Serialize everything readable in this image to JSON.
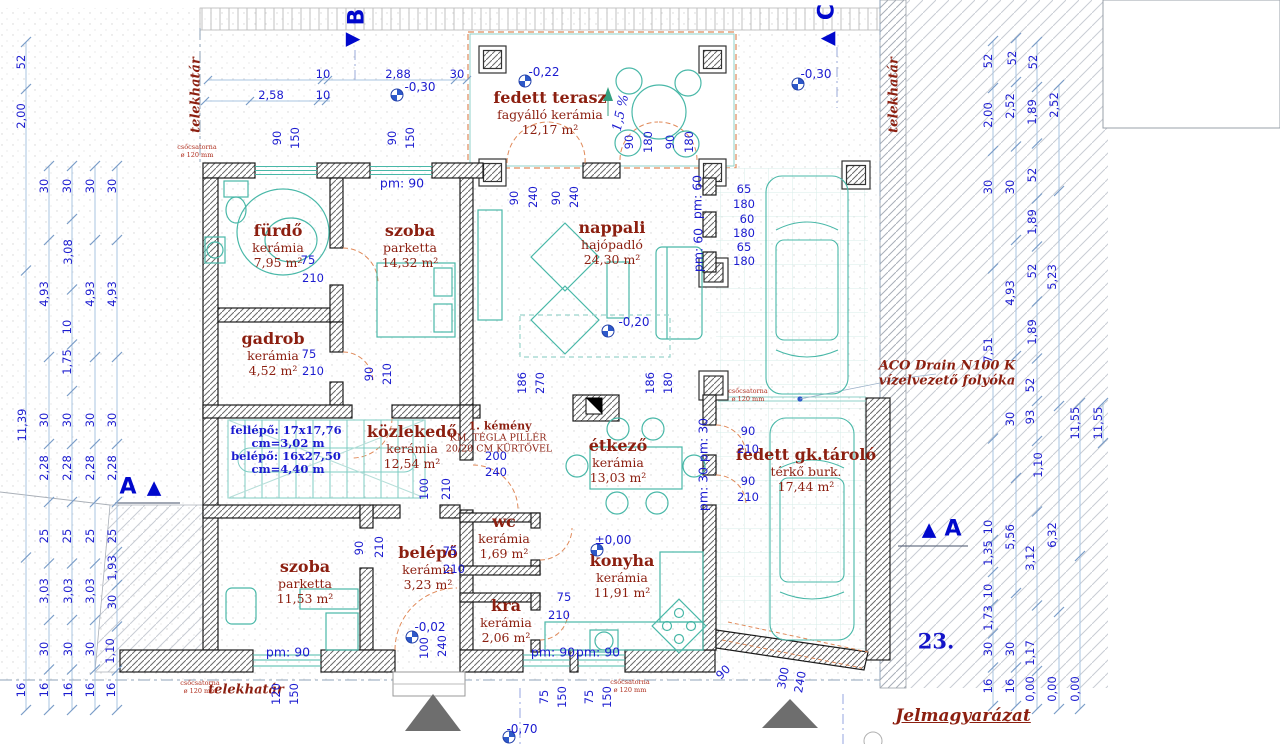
{
  "sheet": {
    "number": "23.",
    "legend_title": "Jelmagyarázat"
  },
  "colors": {
    "dim_blue": "#1b1bd0",
    "room_red": "#8c1f10",
    "teal": "#49b8a8",
    "orange": "#e08a5a",
    "section_blue": "#0008cc"
  },
  "rooms": [
    {
      "id": "furdo",
      "name": "fürdő",
      "finish": "kerámia",
      "area": "7,95 m²",
      "x": 278,
      "y": 243
    },
    {
      "id": "szoba-top",
      "name": "szoba",
      "finish": "parketta",
      "area": "14,32 m²",
      "x": 410,
      "y": 243
    },
    {
      "id": "gadrob",
      "name": "gadrob",
      "finish": "kerámia",
      "area": "4,52 m²",
      "x": 273,
      "y": 351
    },
    {
      "id": "fedett-terasz",
      "name": "fedett terasz",
      "finish": "fagyálló kerámia",
      "area": "12,17 m²",
      "x": 550,
      "y": 110
    },
    {
      "id": "nappali",
      "name": "nappali",
      "finish": "hajópadló",
      "area": "24,30 m²",
      "x": 612,
      "y": 240
    },
    {
      "id": "etkezo",
      "name": "étkező",
      "finish": "kerámia",
      "area": "13,03 m²",
      "x": 618,
      "y": 458
    },
    {
      "id": "kozlekedo",
      "name": "közlekedő",
      "finish": "kerámia",
      "area": "12,54 m²",
      "x": 412,
      "y": 444
    },
    {
      "id": "wc",
      "name": "wc",
      "finish": "kerámia",
      "area": "1,69 m²",
      "x": 504,
      "y": 534
    },
    {
      "id": "konyha",
      "name": "konyha",
      "finish": "kerámia",
      "area": "11,91 m²",
      "x": 622,
      "y": 573
    },
    {
      "id": "belepo",
      "name": "belépő",
      "finish": "kerámia",
      "area": "3,23 m²",
      "x": 428,
      "y": 565
    },
    {
      "id": "kra",
      "name": "kra",
      "finish": "kerámia",
      "area": "2,06 m²",
      "x": 506,
      "y": 618
    },
    {
      "id": "szoba-bottom",
      "name": "szoba",
      "finish": "parketta",
      "area": "11,53 m²",
      "x": 305,
      "y": 579
    },
    {
      "id": "fedett-gk-tarolo",
      "name": "fedett gk.tároló",
      "finish": "térkő burk.",
      "area": "17,44 m²",
      "x": 806,
      "y": 467
    }
  ],
  "texts": [
    {
      "n": "telekhatar-left",
      "t": "telekhatár",
      "x": 196,
      "y": 95,
      "r": -90,
      "c": "redital"
    },
    {
      "n": "telekhatar-right",
      "t": "telekhatár",
      "x": 894,
      "y": 95,
      "r": -90,
      "c": "redital"
    },
    {
      "n": "telekhatar-bottom",
      "t": "telekhatár",
      "x": 246,
      "y": 690,
      "c": "redital"
    },
    {
      "n": "aco-drain-line1",
      "t": "ACO Drain N100 K",
      "x": 947,
      "y": 366,
      "c": "redital"
    },
    {
      "n": "aco-drain-line2",
      "t": "vízelvezető folyóka",
      "x": 947,
      "y": 381,
      "c": "redital"
    },
    {
      "n": "kemeny-note-1",
      "t": "1. kémény",
      "x": 500,
      "y": 426,
      "c": "kem1"
    },
    {
      "n": "kemeny-note-2",
      "t": "KM. TÉGLA PILLÉR",
      "x": 498,
      "y": 438,
      "c": "kem2"
    },
    {
      "n": "kemeny-note-3",
      "t": "20/20 CM KÜRTŐVEL",
      "x": 499,
      "y": 449,
      "c": "kem2"
    },
    {
      "n": "stair-note-1",
      "t": "fellépő: 17x17,76",
      "x": 286,
      "y": 430,
      "c": "bluebold"
    },
    {
      "n": "stair-note-2",
      "t": "cm=3,02 m",
      "x": 288,
      "y": 443,
      "c": "bluebold"
    },
    {
      "n": "stair-note-3",
      "t": "belépő: 16x27,50",
      "x": 286,
      "y": 456,
      "c": "bluebold"
    },
    {
      "n": "stair-note-4",
      "t": "cm=4,40 m",
      "x": 288,
      "y": 469,
      "c": "bluebold"
    },
    {
      "n": "downpipe-note-1",
      "t": "csőcsatorna\nø 120 mm",
      "x": 197,
      "y": 151,
      "c": "tiny"
    },
    {
      "n": "downpipe-note-2",
      "t": "csőcsatorna\nø 120 mm",
      "x": 748,
      "y": 395,
      "c": "tiny"
    },
    {
      "n": "downpipe-note-3",
      "t": "csőcsatorna\nø 120 mm",
      "x": 200,
      "y": 687,
      "c": "tiny"
    },
    {
      "n": "downpipe-note-4",
      "t": "csőcsatorna\nø 120 mm",
      "x": 630,
      "y": 686,
      "c": "tiny"
    },
    {
      "n": "slope-label",
      "t": "1,5 %",
      "x": 621,
      "y": 113,
      "r": -78,
      "c": "pct"
    }
  ],
  "levels": [
    {
      "t": "-0,22",
      "sx": 525,
      "sy": 81,
      "tx": 544,
      "ty": 72
    },
    {
      "t": "-0,30",
      "sx": 397,
      "sy": 95,
      "tx": 420,
      "ty": 87
    },
    {
      "t": "-0,30",
      "sx": 798,
      "sy": 84,
      "tx": 816,
      "ty": 74
    },
    {
      "t": "-0,20",
      "sx": 608,
      "sy": 331,
      "tx": 634,
      "ty": 322
    },
    {
      "t": "±0,00",
      "sx": 597,
      "sy": 550,
      "tx": 613,
      "ty": 540
    },
    {
      "t": "-0,02",
      "sx": 412,
      "sy": 637,
      "tx": 430,
      "ty": 627
    },
    {
      "t": "-0,70",
      "sx": 509,
      "sy": 737,
      "tx": 522,
      "ty": 729
    }
  ],
  "sections": [
    {
      "letter": "B",
      "lx": 357,
      "ly": 17,
      "lr": -90,
      "tri": "▶",
      "tx": 353,
      "ty": 39
    },
    {
      "letter": "C",
      "lx": 827,
      "ly": 12,
      "lr": -90,
      "tri": "◀",
      "tx": 828,
      "ty": 38
    },
    {
      "letter": "A",
      "lx": 128,
      "ly": 487,
      "tri": "▲",
      "tx": 154,
      "ty": 488
    },
    {
      "letter": "A",
      "lx": 953,
      "ly": 529,
      "tri": "▲",
      "tx": 929,
      "ty": 530
    }
  ],
  "dims": [
    {
      "t": "10",
      "x": 323,
      "y": 74
    },
    {
      "t": "2,88",
      "x": 398,
      "y": 74
    },
    {
      "t": "30",
      "x": 457,
      "y": 74
    },
    {
      "t": "2,58",
      "x": 271,
      "y": 95
    },
    {
      "t": "10",
      "x": 323,
      "y": 95
    },
    {
      "t": "90",
      "x": 277,
      "y": 138,
      "r": -90
    },
    {
      "t": "150",
      "x": 295,
      "y": 138,
      "r": -90
    },
    {
      "t": "90",
      "x": 392,
      "y": 138,
      "r": -90
    },
    {
      "t": "150",
      "x": 410,
      "y": 138,
      "r": -90
    },
    {
      "t": "90",
      "x": 629,
      "y": 142,
      "r": -90
    },
    {
      "t": "180",
      "x": 648,
      "y": 142,
      "r": -90
    },
    {
      "t": "90",
      "x": 670,
      "y": 142,
      "r": -90
    },
    {
      "t": "180",
      "x": 689,
      "y": 142,
      "r": -90
    },
    {
      "t": "90",
      "x": 514,
      "y": 198,
      "r": -90
    },
    {
      "t": "240",
      "x": 533,
      "y": 197,
      "r": -90
    },
    {
      "t": "90",
      "x": 556,
      "y": 198,
      "r": -90
    },
    {
      "t": "240",
      "x": 574,
      "y": 197,
      "r": -90
    },
    {
      "t": "pm: 90",
      "x": 402,
      "y": 183,
      "c": "pm"
    },
    {
      "t": "pm: 60",
      "x": 697,
      "y": 197,
      "r": -90,
      "c": "pm"
    },
    {
      "t": "pm: 60",
      "x": 698,
      "y": 250,
      "r": -90,
      "c": "pm"
    },
    {
      "t": "pm: 30",
      "x": 703,
      "y": 440,
      "r": -90,
      "c": "pm"
    },
    {
      "t": "pm: 30",
      "x": 703,
      "y": 489,
      "r": -90,
      "c": "pm"
    },
    {
      "t": "pm: 90",
      "x": 288,
      "y": 652,
      "c": "pm"
    },
    {
      "t": "pm: 90",
      "x": 553,
      "y": 652,
      "c": "pm"
    },
    {
      "t": "pm: 90",
      "x": 598,
      "y": 652,
      "c": "pm"
    },
    {
      "t": "65",
      "x": 744,
      "y": 189
    },
    {
      "t": "180",
      "x": 744,
      "y": 204
    },
    {
      "t": "60",
      "x": 747,
      "y": 219
    },
    {
      "t": "180",
      "x": 744,
      "y": 233
    },
    {
      "t": "65",
      "x": 744,
      "y": 247
    },
    {
      "t": "180",
      "x": 744,
      "y": 261
    },
    {
      "t": "75",
      "x": 308,
      "y": 260
    },
    {
      "t": "210",
      "x": 313,
      "y": 278
    },
    {
      "t": "75",
      "x": 309,
      "y": 354
    },
    {
      "t": "210",
      "x": 313,
      "y": 371
    },
    {
      "t": "90",
      "x": 369,
      "y": 374,
      "r": -90
    },
    {
      "t": "210",
      "x": 387,
      "y": 374,
      "r": -90
    },
    {
      "t": "186",
      "x": 522,
      "y": 383,
      "r": -90
    },
    {
      "t": "270",
      "x": 540,
      "y": 383,
      "r": -90
    },
    {
      "t": "186",
      "x": 650,
      "y": 383,
      "r": -90
    },
    {
      "t": "180",
      "x": 668,
      "y": 383,
      "r": -90
    },
    {
      "t": "200",
      "x": 496,
      "y": 456
    },
    {
      "t": "240",
      "x": 496,
      "y": 472
    },
    {
      "t": "100",
      "x": 424,
      "y": 489,
      "r": -90
    },
    {
      "t": "210",
      "x": 446,
      "y": 489,
      "r": -90
    },
    {
      "t": "90",
      "x": 359,
      "y": 548,
      "r": -90
    },
    {
      "t": "210",
      "x": 379,
      "y": 547,
      "r": -90
    },
    {
      "t": "75",
      "x": 450,
      "y": 551
    },
    {
      "t": "210",
      "x": 454,
      "y": 569
    },
    {
      "t": "75",
      "x": 564,
      "y": 597
    },
    {
      "t": "210",
      "x": 559,
      "y": 615
    },
    {
      "t": "90",
      "x": 748,
      "y": 431
    },
    {
      "t": "210",
      "x": 748,
      "y": 449
    },
    {
      "t": "90",
      "x": 748,
      "y": 481
    },
    {
      "t": "210",
      "x": 748,
      "y": 497
    },
    {
      "t": "75",
      "x": 544,
      "y": 697,
      "r": -90
    },
    {
      "t": "150",
      "x": 562,
      "y": 697,
      "r": -90
    },
    {
      "t": "75",
      "x": 589,
      "y": 697,
      "r": -90
    },
    {
      "t": "150",
      "x": 607,
      "y": 697,
      "r": -90
    },
    {
      "t": "120",
      "x": 276,
      "y": 694,
      "r": -90
    },
    {
      "t": "150",
      "x": 294,
      "y": 694,
      "r": -90
    },
    {
      "t": "100",
      "x": 424,
      "y": 648,
      "r": -90
    },
    {
      "t": "240",
      "x": 442,
      "y": 646,
      "r": -90
    },
    {
      "t": "300",
      "x": 783,
      "y": 678,
      "r": -80
    },
    {
      "t": "240",
      "x": 800,
      "y": 682,
      "r": -80
    },
    {
      "t": "90",
      "x": 723,
      "y": 672,
      "r": -45
    },
    {
      "t": "52",
      "x": 21,
      "y": 62,
      "r": -90
    },
    {
      "t": "2,00",
      "x": 21,
      "y": 116,
      "r": -90
    },
    {
      "t": "11,39",
      "x": 22,
      "y": 425,
      "r": -90
    },
    {
      "t": "16",
      "x": 21,
      "y": 690,
      "r": -90
    },
    {
      "t": "30",
      "x": 44,
      "y": 186,
      "r": -90
    },
    {
      "t": "4,93",
      "x": 44,
      "y": 294,
      "r": -90
    },
    {
      "t": "30",
      "x": 44,
      "y": 420,
      "r": -90
    },
    {
      "t": "2,28",
      "x": 44,
      "y": 468,
      "r": -90
    },
    {
      "t": "25",
      "x": 44,
      "y": 536,
      "r": -90
    },
    {
      "t": "3,03",
      "x": 44,
      "y": 591,
      "r": -90
    },
    {
      "t": "30",
      "x": 44,
      "y": 649,
      "r": -90
    },
    {
      "t": "16",
      "x": 44,
      "y": 690,
      "r": -90
    },
    {
      "t": "30",
      "x": 67,
      "y": 186,
      "r": -90
    },
    {
      "t": "3,08",
      "x": 68,
      "y": 252,
      "r": -90
    },
    {
      "t": "10",
      "x": 67,
      "y": 327,
      "r": -90
    },
    {
      "t": "1,75",
      "x": 67,
      "y": 362,
      "r": -90
    },
    {
      "t": "30",
      "x": 67,
      "y": 420,
      "r": -90
    },
    {
      "t": "2,28",
      "x": 67,
      "y": 468,
      "r": -90
    },
    {
      "t": "25",
      "x": 67,
      "y": 536,
      "r": -90
    },
    {
      "t": "3,03",
      "x": 68,
      "y": 591,
      "r": -90
    },
    {
      "t": "30",
      "x": 68,
      "y": 649,
      "r": -90
    },
    {
      "t": "16",
      "x": 68,
      "y": 690,
      "r": -90
    },
    {
      "t": "30",
      "x": 90,
      "y": 186,
      "r": -90
    },
    {
      "t": "4,93",
      "x": 90,
      "y": 294,
      "r": -90
    },
    {
      "t": "30",
      "x": 90,
      "y": 420,
      "r": -90
    },
    {
      "t": "2,28",
      "x": 90,
      "y": 468,
      "r": -90
    },
    {
      "t": "25",
      "x": 90,
      "y": 536,
      "r": -90
    },
    {
      "t": "3,03",
      "x": 90,
      "y": 591,
      "r": -90
    },
    {
      "t": "30",
      "x": 90,
      "y": 649,
      "r": -90
    },
    {
      "t": "16",
      "x": 90,
      "y": 690,
      "r": -90
    },
    {
      "t": "30",
      "x": 112,
      "y": 186,
      "r": -90
    },
    {
      "t": "4,93",
      "x": 112,
      "y": 294,
      "r": -90
    },
    {
      "t": "30",
      "x": 112,
      "y": 420,
      "r": -90
    },
    {
      "t": "2,28",
      "x": 112,
      "y": 468,
      "r": -90
    },
    {
      "t": "25",
      "x": 112,
      "y": 536,
      "r": -90
    },
    {
      "t": "1,93",
      "x": 112,
      "y": 568,
      "r": -90
    },
    {
      "t": "30",
      "x": 112,
      "y": 602,
      "r": -90
    },
    {
      "t": "1,10",
      "x": 110,
      "y": 651,
      "r": -90
    },
    {
      "t": "16",
      "x": 111,
      "y": 690,
      "r": -90
    },
    {
      "t": "52",
      "x": 988,
      "y": 61,
      "r": -90
    },
    {
      "t": "2,00",
      "x": 988,
      "y": 115,
      "r": -90
    },
    {
      "t": "30",
      "x": 988,
      "y": 187,
      "r": -90
    },
    {
      "t": "7,51",
      "x": 988,
      "y": 350,
      "r": -90
    },
    {
      "t": "10",
      "x": 988,
      "y": 527,
      "r": -90
    },
    {
      "t": "1,35",
      "x": 988,
      "y": 553,
      "r": -90
    },
    {
      "t": "10",
      "x": 988,
      "y": 591,
      "r": -90
    },
    {
      "t": "1,73",
      "x": 988,
      "y": 618,
      "r": -90
    },
    {
      "t": "30",
      "x": 988,
      "y": 649,
      "r": -90
    },
    {
      "t": "16",
      "x": 988,
      "y": 686,
      "r": -90
    },
    {
      "t": "52",
      "x": 1012,
      "y": 58,
      "r": -90
    },
    {
      "t": "2,52",
      "x": 1010,
      "y": 106,
      "r": -90
    },
    {
      "t": "30",
      "x": 1010,
      "y": 187,
      "r": -90
    },
    {
      "t": "4,93",
      "x": 1010,
      "y": 293,
      "r": -90
    },
    {
      "t": "30",
      "x": 1010,
      "y": 419,
      "r": -90
    },
    {
      "t": "5,56",
      "x": 1010,
      "y": 537,
      "r": -90
    },
    {
      "t": "30",
      "x": 1010,
      "y": 649,
      "r": -90
    },
    {
      "t": "16",
      "x": 1010,
      "y": 686,
      "r": -90
    },
    {
      "t": "52",
      "x": 1033,
      "y": 62,
      "r": -90
    },
    {
      "t": "1,89",
      "x": 1032,
      "y": 112,
      "r": -90
    },
    {
      "t": "52",
      "x": 1032,
      "y": 175,
      "r": -90
    },
    {
      "t": "1,89",
      "x": 1032,
      "y": 222,
      "r": -90
    },
    {
      "t": "52",
      "x": 1032,
      "y": 271,
      "r": -90
    },
    {
      "t": "1,89",
      "x": 1032,
      "y": 332,
      "r": -90
    },
    {
      "t": "52",
      "x": 1030,
      "y": 385,
      "r": -90
    },
    {
      "t": "93",
      "x": 1030,
      "y": 417,
      "r": -90
    },
    {
      "t": "1,10",
      "x": 1038,
      "y": 465,
      "r": -90
    },
    {
      "t": "3,12",
      "x": 1030,
      "y": 558,
      "r": -90
    },
    {
      "t": "1,17",
      "x": 1030,
      "y": 653,
      "r": -90
    },
    {
      "t": "0,00",
      "x": 1030,
      "y": 689,
      "r": -90
    },
    {
      "t": "2,52",
      "x": 1054,
      "y": 105,
      "r": -90
    },
    {
      "t": "5,23",
      "x": 1052,
      "y": 277,
      "r": -90
    },
    {
      "t": "6,32",
      "x": 1052,
      "y": 535,
      "r": -90
    },
    {
      "t": "0,00",
      "x": 1052,
      "y": 689,
      "r": -90
    },
    {
      "t": "11,55",
      "x": 1075,
      "y": 423,
      "r": -90
    },
    {
      "t": "0,00",
      "x": 1075,
      "y": 689,
      "r": -90
    },
    {
      "t": "11,55",
      "x": 1098,
      "y": 423,
      "r": -90
    }
  ]
}
